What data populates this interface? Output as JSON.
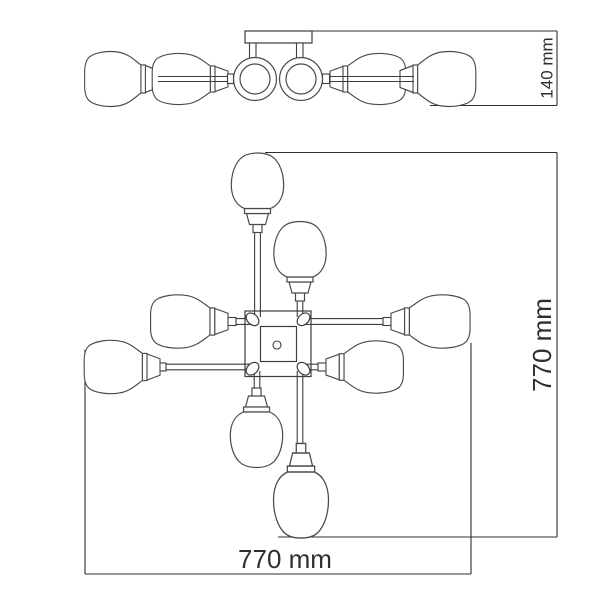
{
  "drawing": {
    "kind": "chandelier-dimension-drawing",
    "side_view": {
      "height_label": "140 mm"
    },
    "plan_view": {
      "height_label": "770 mm",
      "width_label": "770 mm"
    },
    "colors": {
      "outline": "#4a4a4a",
      "detail": "#3d3d3d",
      "dimension_line": "#2f2f2f",
      "text": "#2f2f2f",
      "background": "#ffffff"
    }
  }
}
